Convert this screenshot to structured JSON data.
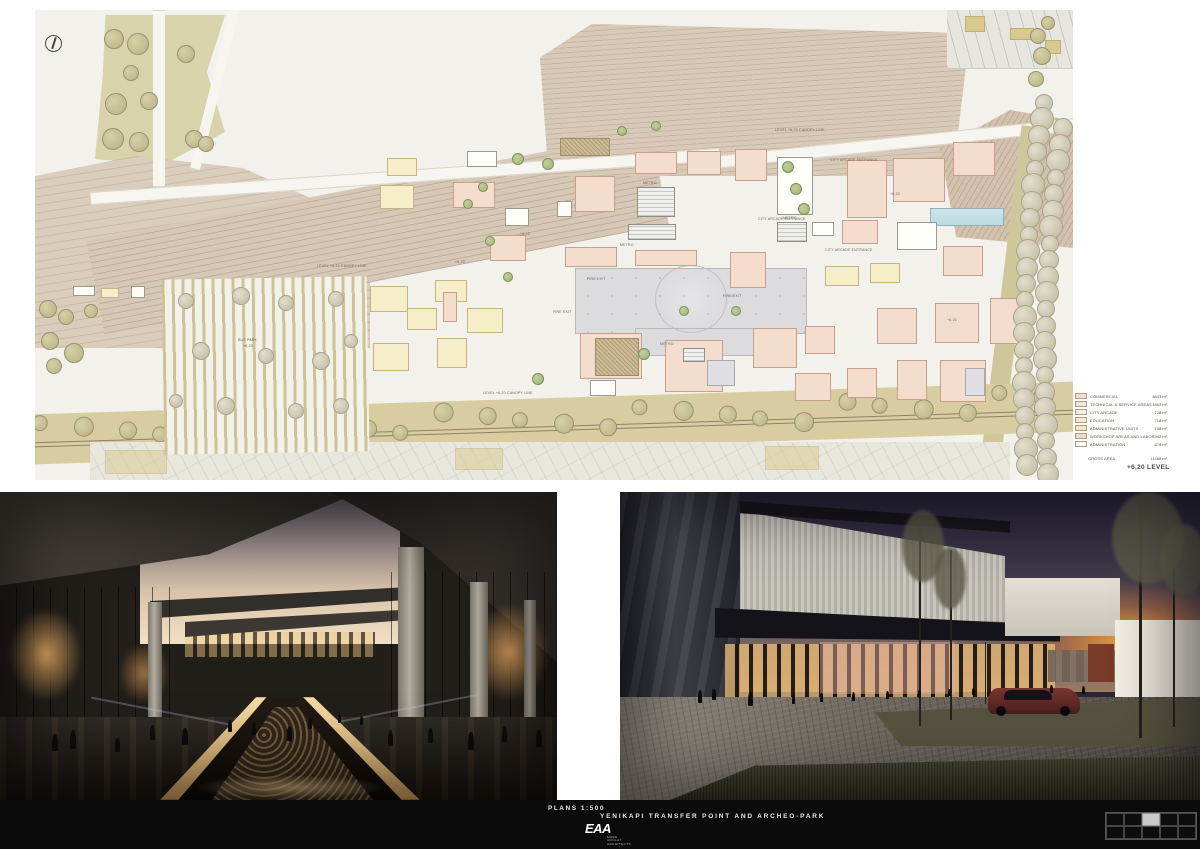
{
  "footer": {
    "plans_label": "PLANS 1:500",
    "title": "YENIKAPI TRANSFER POINT AND ARCHEO-PARK",
    "logo": {
      "text": "EAA",
      "sub": [
        "EMRE",
        "AROLAT",
        "ARCHITECTS"
      ]
    },
    "nav": {
      "cells": 10,
      "cols": 5,
      "active_index": 2
    }
  },
  "legend": {
    "items": [
      {
        "label": "COMMERCIAL",
        "value": "8843 m²",
        "color": "#f4ddcc"
      },
      {
        "label": "TECHNICAL & SERVICE AREAS",
        "value": "1862 m²",
        "color": "#efe8de"
      },
      {
        "label": "CITY ARCADE",
        "value": "728 m²",
        "color": "#f8ece4"
      },
      {
        "label": "EDUCATION",
        "value": "718 m²",
        "color": "#f6eec8"
      },
      {
        "label": "ADMINISTRATIVE UNITS",
        "value": "158 m²",
        "color": "#f1e7c2"
      },
      {
        "label": "WORKSHOP AREAS AND LABORATORIES",
        "value": "942 m²",
        "color": "#ecdfc0"
      },
      {
        "label": "ADMINISTRATION",
        "value": "879 m²",
        "color": "#ffffff"
      }
    ],
    "gross": {
      "label": "GROSS AREA",
      "value": "11468 m²"
    },
    "level_label": "+6,20 LEVEL"
  },
  "plan": {
    "labels": [
      {
        "t": "METRO",
        "x": 608,
        "y": 171
      },
      {
        "t": "METRO",
        "x": 585,
        "y": 233
      },
      {
        "t": "METRO",
        "x": 748,
        "y": 206
      },
      {
        "t": "METRO",
        "x": 625,
        "y": 332
      },
      {
        "t": "CITY ARCADE ENTRANCE",
        "x": 723,
        "y": 207
      },
      {
        "t": "CITY ARCADE ENTRANCE",
        "x": 790,
        "y": 238
      },
      {
        "t": "CITY ARCADE ENTRANCE",
        "x": 795,
        "y": 148
      },
      {
        "t": "FIRE EXIT",
        "x": 552,
        "y": 267
      },
      {
        "t": "FIRE EXIT",
        "x": 688,
        "y": 284
      },
      {
        "t": "FIRE EXIT",
        "x": 518,
        "y": 300
      },
      {
        "t": "LEVEL +6,20 CANOPY LINE",
        "x": 448,
        "y": 381
      },
      {
        "t": "LEVEL +6,20 CANOPY LINE",
        "x": 282,
        "y": 254
      },
      {
        "t": "LEVEL +6,20 CANOPY LINE",
        "x": 740,
        "y": 118
      },
      {
        "t": "BUS PARK",
        "x": 203,
        "y": 328
      },
      {
        "t": "+6,20",
        "x": 208,
        "y": 334
      },
      {
        "t": "+6,20",
        "x": 485,
        "y": 222
      },
      {
        "t": "+6,20",
        "x": 855,
        "y": 182
      },
      {
        "t": "+6,20",
        "x": 912,
        "y": 308
      },
      {
        "t": "+6,20",
        "x": 420,
        "y": 250
      }
    ],
    "blocks": [
      [
        525,
        128,
        50,
        18,
        "t"
      ],
      [
        600,
        142,
        42,
        22,
        "p"
      ],
      [
        652,
        141,
        34,
        24,
        "p"
      ],
      [
        700,
        139,
        32,
        32,
        "p"
      ],
      [
        432,
        141,
        30,
        16,
        "w"
      ],
      [
        352,
        148,
        30,
        18,
        "y"
      ],
      [
        345,
        175,
        34,
        24,
        "y"
      ],
      [
        540,
        166,
        40,
        36,
        "p"
      ],
      [
        418,
        172,
        42,
        26,
        "p"
      ],
      [
        742,
        147,
        36,
        58,
        "w"
      ],
      [
        812,
        150,
        40,
        58,
        "p"
      ],
      [
        858,
        148,
        52,
        44,
        "p"
      ],
      [
        918,
        132,
        42,
        34,
        "p"
      ],
      [
        602,
        177,
        38,
        30,
        "h"
      ],
      [
        593,
        214,
        48,
        16,
        "h"
      ],
      [
        470,
        198,
        24,
        18,
        "w"
      ],
      [
        522,
        191,
        15,
        16,
        "w"
      ],
      [
        455,
        225,
        36,
        26,
        "p"
      ],
      [
        742,
        212,
        30,
        20,
        "h"
      ],
      [
        777,
        212,
        22,
        14,
        "w"
      ],
      [
        807,
        210,
        36,
        24,
        "p"
      ],
      [
        862,
        212,
        40,
        28,
        "w"
      ],
      [
        908,
        236,
        40,
        30,
        "p"
      ],
      [
        530,
        237,
        52,
        20,
        "p"
      ],
      [
        600,
        240,
        62,
        16,
        "p"
      ],
      [
        695,
        242,
        36,
        36,
        "p"
      ],
      [
        835,
        253,
        30,
        20,
        "y"
      ],
      [
        790,
        256,
        34,
        20,
        "y"
      ],
      [
        335,
        276,
        38,
        26,
        "y"
      ],
      [
        400,
        270,
        32,
        22,
        "y"
      ],
      [
        372,
        298,
        30,
        22,
        "y"
      ],
      [
        432,
        298,
        36,
        25,
        "y"
      ],
      [
        338,
        333,
        36,
        28,
        "y"
      ],
      [
        402,
        328,
        30,
        30,
        "y"
      ],
      [
        408,
        282,
        14,
        30,
        "p"
      ],
      [
        545,
        323,
        62,
        46,
        "p"
      ],
      [
        630,
        330,
        58,
        52,
        "p"
      ],
      [
        672,
        350,
        28,
        26,
        "g"
      ],
      [
        648,
        338,
        22,
        14,
        "h"
      ],
      [
        718,
        318,
        44,
        40,
        "p"
      ],
      [
        770,
        316,
        30,
        28,
        "p"
      ],
      [
        560,
        328,
        44,
        38,
        "t"
      ],
      [
        842,
        298,
        40,
        36,
        "p"
      ],
      [
        900,
        293,
        44,
        40,
        "p"
      ],
      [
        955,
        288,
        40,
        46,
        "p"
      ],
      [
        862,
        350,
        30,
        40,
        "p"
      ],
      [
        812,
        358,
        30,
        30,
        "p"
      ],
      [
        760,
        363,
        36,
        28,
        "p"
      ],
      [
        905,
        350,
        46,
        42,
        "p"
      ],
      [
        930,
        358,
        20,
        28,
        "g"
      ],
      [
        555,
        370,
        26,
        16,
        "w"
      ],
      [
        38,
        276,
        22,
        10,
        "w"
      ],
      [
        66,
        278,
        18,
        10,
        "y"
      ],
      [
        96,
        276,
        14,
        12,
        "w"
      ]
    ],
    "green_trees": [
      [
        482,
        148,
        5
      ],
      [
        512,
        153,
        5
      ],
      [
        447,
        176,
        4
      ],
      [
        432,
        193,
        4
      ],
      [
        454,
        230,
        4
      ],
      [
        472,
        266,
        4
      ],
      [
        502,
        368,
        5
      ],
      [
        608,
        343,
        5
      ],
      [
        752,
        156,
        5
      ],
      [
        760,
        178,
        5
      ],
      [
        768,
        198,
        5
      ],
      [
        648,
        300,
        4
      ],
      [
        700,
        300,
        4
      ],
      [
        586,
        120,
        4
      ],
      [
        620,
        115,
        4
      ]
    ],
    "park_trees": [
      [
        78,
        28,
        9
      ],
      [
        102,
        33,
        10
      ],
      [
        150,
        43,
        8
      ],
      [
        80,
        93,
        10
      ],
      [
        113,
        90,
        8
      ],
      [
        77,
        128,
        10
      ],
      [
        103,
        131,
        9
      ],
      [
        158,
        128,
        8
      ],
      [
        170,
        133,
        7
      ],
      [
        95,
        62,
        7
      ],
      [
        12,
        298,
        8
      ],
      [
        30,
        306,
        7
      ],
      [
        14,
        330,
        8
      ],
      [
        38,
        342,
        9
      ],
      [
        18,
        355,
        7
      ],
      [
        55,
        300,
        6
      ],
      [
        1002,
        25,
        7
      ],
      [
        1006,
        45,
        8
      ],
      [
        1000,
        68,
        7
      ],
      [
        1012,
        12,
        6
      ]
    ],
    "stripe_trees": [
      [
        150,
        290,
        7
      ],
      [
        205,
        285,
        8
      ],
      [
        250,
        292,
        7
      ],
      [
        300,
        288,
        7
      ],
      [
        165,
        340,
        8
      ],
      [
        230,
        345,
        7
      ],
      [
        285,
        350,
        8
      ],
      [
        315,
        330,
        6
      ],
      [
        190,
        395,
        8
      ],
      [
        260,
        400,
        7
      ],
      [
        305,
        395,
        7
      ],
      [
        140,
        390,
        6
      ]
    ]
  }
}
